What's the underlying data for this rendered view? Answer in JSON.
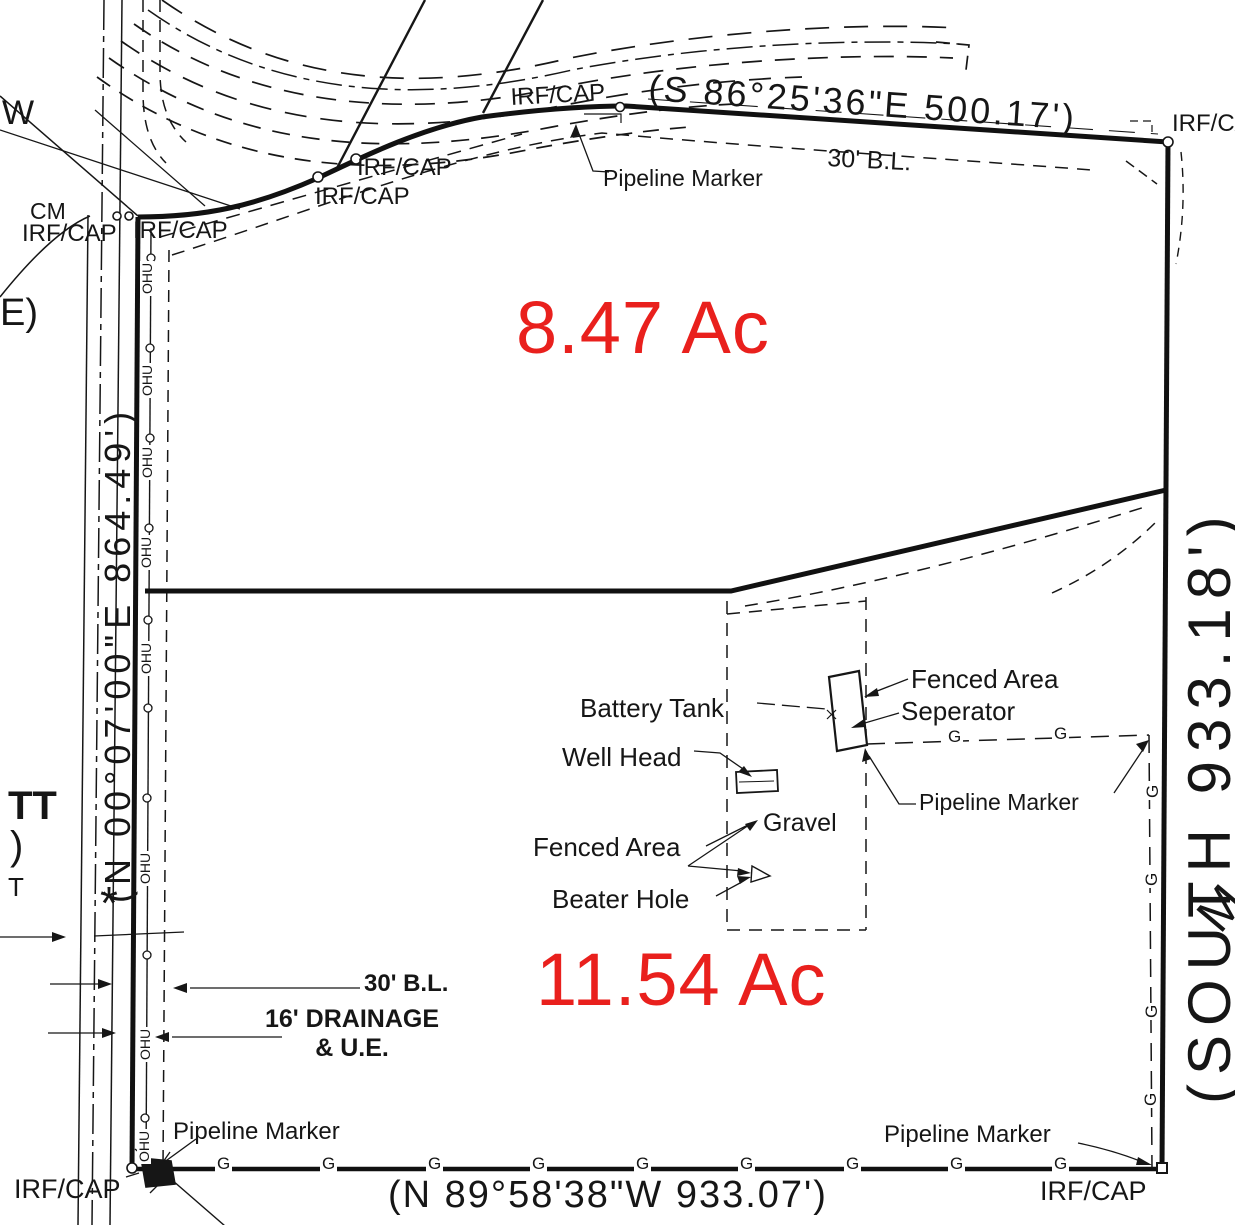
{
  "colors": {
    "red": "#e9201d",
    "ink": "#161616"
  },
  "parcels": {
    "north": "8.47 Ac",
    "south": "11.54 Ac"
  },
  "bearings": {
    "north": "(S 86°25'36\"E 500.17')",
    "west": "(N 00°07'00\"E 864.49')",
    "east": "(SOUTH 933.18')",
    "south": "(N 89°58'38\"W 933.07')"
  },
  "monuments": {
    "irf_cap": "IRF/CAP",
    "cm": "CM"
  },
  "annotations": {
    "pipeline_marker": "Pipeline Marker",
    "building_line": "30' B.L.",
    "drainage": "16' DRAINAGE\n& U.E.",
    "battery_tank": "Battery Tank",
    "well_head": "Well Head",
    "fenced_area": "Fenced Area",
    "seperator": "Seperator",
    "gravel": "Gravel",
    "beater_hole": "Beater Hole"
  },
  "utilities": {
    "ohu": "OHU",
    "gas": "G"
  },
  "edge_fragments": {
    "w": "W",
    "e": "E)",
    "tt": "TT",
    "paren": ")",
    "t": "T",
    "m": "M",
    "star": "*"
  }
}
